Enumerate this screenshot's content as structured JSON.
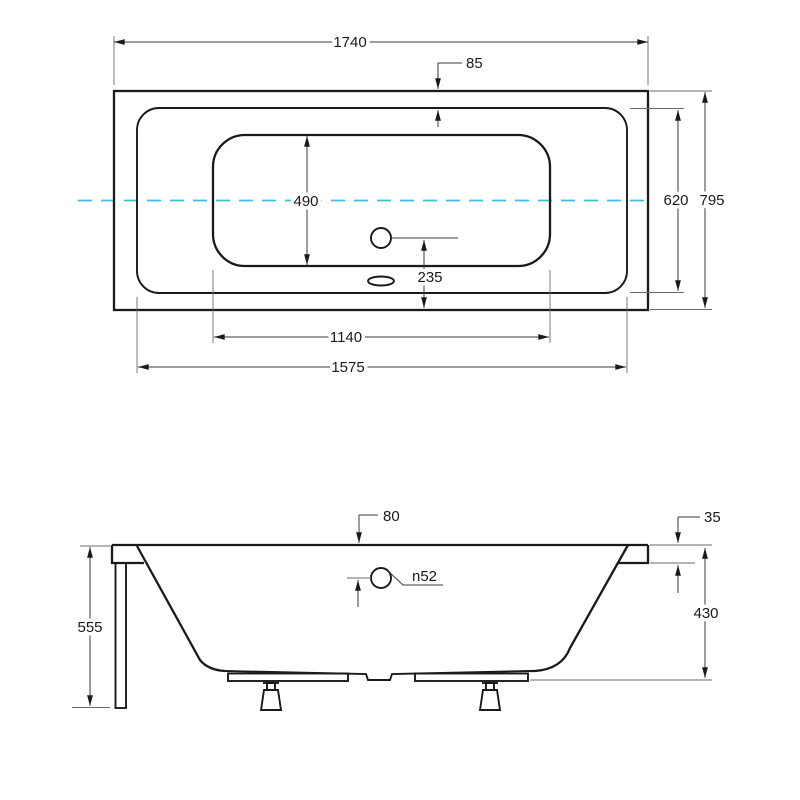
{
  "colors": {
    "line": "#1a1a1a",
    "dimension": "#3a3a3a",
    "centerline": "#3bbfdf",
    "background": "#ffffff"
  },
  "top_view": {
    "overall_length": "1740",
    "rim_edge_offset": "85",
    "basin_width": "490",
    "inner_width": "620",
    "overall_width": "795",
    "drain_to_edge": "235",
    "basin_length": "1140",
    "inner_length": "1575"
  },
  "side_view": {
    "drain_offset": "80",
    "rim_height": "35",
    "drain_diameter": "n52",
    "inner_depth": "430",
    "total_height": "555"
  }
}
